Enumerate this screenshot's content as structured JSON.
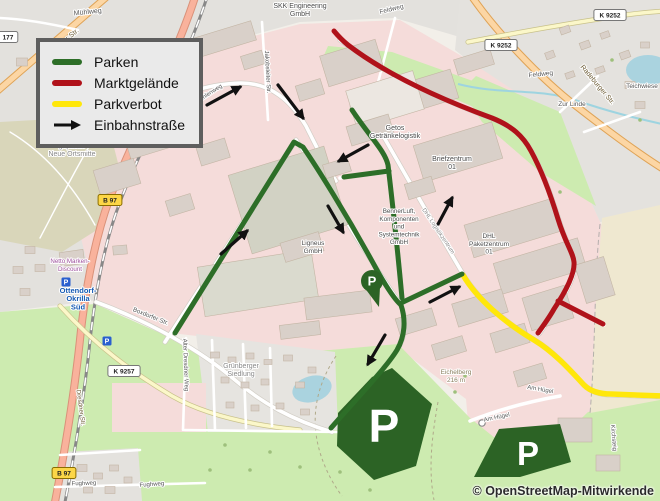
{
  "legend": {
    "items": [
      {
        "label": "Parken",
        "color": "#2d6e28",
        "type": "line"
      },
      {
        "label": "Marktgelände",
        "color": "#b0121a",
        "type": "line"
      },
      {
        "label": "Parkverbot",
        "color": "#ffe70a",
        "type": "line"
      },
      {
        "label": "Einbahnstraße",
        "color": "#111111",
        "type": "arrow"
      }
    ]
  },
  "attribution": "© OpenStreetMap-Mitwirkende",
  "map": {
    "overlays": {
      "parken_color": "#2d6e28",
      "markt_color": "#b0121a",
      "parkverbot_color": "#ffe70a",
      "green_paths": [
        "M175,333 L294,142 L303,147 C316,166 346,213 378,272 C386,286 394,299 401,305",
        "M401,305 C406,320 405,336 397,350 C386,368 358,397 331,428",
        "M401,303 L462,274",
        "M352,110 C370,137 385,151 388,165 C392,199 398,254 402,298",
        "M389,171 L344,177"
      ],
      "red_paths": [
        "M334,31 C339,37 343,41 348,45 C382,71 432,96 492,118 C512,126 523,136 531,151 C543,173 551,196 558,219 C566,245 573,252 574,262 C575,273 566,291 554,309 C549,318 543,326 538,333",
        "M558,301 L603,324"
      ],
      "yellow_paths": [
        "M463,275 C477,299 504,322 534,340 C554,352 571,371 584,385 C590,391 599,394 611,394 L662,396"
      ],
      "arrows": [
        [
          207,
          105,
          240,
          87
        ],
        [
          278,
          85,
          303,
          118
        ],
        [
          368,
          145,
          339,
          161
        ],
        [
          328,
          206,
          343,
          232
        ],
        [
          221,
          254,
          247,
          231
        ],
        [
          436,
          228,
          452,
          198
        ],
        [
          430,
          302,
          459,
          287
        ],
        [
          385,
          335,
          368,
          364
        ]
      ]
    },
    "p_areas": {
      "fill": "#2c6325",
      "label": "P",
      "shapes": [
        {
          "points": "338,413 372,377 392,368 432,404 416,466 374,480 337,446",
          "px": 384,
          "py": 442,
          "fs": 46
        },
        {
          "points": "474,477 499,429 560,424 571,462 520,477",
          "px": 528,
          "py": 465,
          "fs": 33
        }
      ]
    },
    "pin": {
      "x": 372,
      "y": 281,
      "label": "P",
      "fill": "#2c6325"
    },
    "parking_icons": {
      "label": "P",
      "color": "#2a5fcf",
      "positions": [
        [
          66,
          282
        ],
        [
          107,
          341
        ]
      ]
    },
    "gate_marker": [
      482,
      423
    ],
    "badges": [
      {
        "t": "177",
        "x": 8,
        "y": 37
      },
      {
        "t": "K 9252",
        "x": 501,
        "y": 45
      },
      {
        "t": "K 9252",
        "x": 610,
        "y": 15
      },
      {
        "t": "K 9257",
        "x": 124,
        "y": 371
      },
      {
        "t": "B 97",
        "x": 110,
        "y": 200,
        "b": 1
      },
      {
        "t": "B 97",
        "x": 64,
        "y": 473,
        "b": 1
      }
    ],
    "labels": [
      {
        "lines": [
          "SKK Engineering",
          "GmbH"
        ],
        "x": 300,
        "y": 8,
        "s": 7
      },
      {
        "t": "Mühlweg",
        "x": 88,
        "y": 14,
        "s": 7,
        "c": "#555",
        "rot": -6
      },
      {
        "t": "Radeburger Str.",
        "x": 60,
        "y": 47,
        "s": 7,
        "c": "#6b5a33",
        "rot": -39
      },
      {
        "t": "Feldweg",
        "x": 392,
        "y": 11,
        "s": 6.5,
        "c": "#555",
        "rot": -14
      },
      {
        "t": "Feldweg",
        "x": 541,
        "y": 76,
        "s": 6.5,
        "c": "#555",
        "rot": -6
      },
      {
        "t": "Teichwiese",
        "x": 642,
        "y": 88,
        "s": 6.5,
        "c": "#555"
      },
      {
        "t": "Zur Linde",
        "x": 572,
        "y": 106,
        "s": 6.5,
        "c": "#555"
      },
      {
        "t": "Radeburger Str.",
        "x": 596,
        "y": 86,
        "s": 7,
        "c": "#6b5a33",
        "rot": 50
      },
      {
        "lines": [
          "Getos",
          "Getränkelogistik"
        ],
        "x": 395,
        "y": 130,
        "s": 7
      },
      {
        "lines": [
          "Briefzentrum",
          "01"
        ],
        "x": 452,
        "y": 161,
        "s": 7
      },
      {
        "t": "DHL Logistikzentrum",
        "x": 437,
        "y": 232,
        "s": 5.8,
        "c": "#8a8a8a",
        "rot": 56
      },
      {
        "lines": [
          "BennerLuft,",
          "Komponenten",
          "und",
          "Systemtechnik",
          "GmbH"
        ],
        "x": 399,
        "y": 213,
        "s": 6.3
      },
      {
        "lines": [
          "DHL",
          "Paketzentrum",
          "01"
        ],
        "x": 489,
        "y": 238,
        "s": 6.5
      },
      {
        "lines": [
          "Ligneus",
          "GmbH"
        ],
        "x": 313,
        "y": 245,
        "s": 6.5
      },
      {
        "t": "Jakobsleiter Str.",
        "x": 266,
        "y": 72,
        "s": 6,
        "c": "#555",
        "rot": 87
      },
      {
        "t": "Windmühlenweg",
        "x": 204,
        "y": 99,
        "s": 6,
        "c": "#555",
        "rot": -33
      },
      {
        "lines": [
          "geplante",
          "Neue Ortsmitte"
        ],
        "x": 72,
        "y": 148,
        "s": 7,
        "c": "#888"
      },
      {
        "lines": [
          "Netto Marken-",
          "Discount"
        ],
        "x": 70,
        "y": 263,
        "s": 6.2,
        "c": "#9c4f9c"
      },
      {
        "lines": [
          "Ottendorf-",
          "Okrilla",
          "Süd"
        ],
        "x": 78,
        "y": 293,
        "s": 7.5,
        "c": "#1559b3",
        "w": 700,
        "lh": 8.2
      },
      {
        "t": "Boxdorfer Str.",
        "x": 150,
        "y": 318,
        "s": 6.2,
        "c": "#555",
        "rot": 22
      },
      {
        "t": "Alter Dresdner Weg",
        "x": 184,
        "y": 365,
        "s": 6,
        "c": "#555",
        "rot": 88
      },
      {
        "lines": [
          "Grünberger",
          "Siedlung"
        ],
        "x": 241,
        "y": 368,
        "s": 7,
        "c": "#888"
      },
      {
        "t": "Dresdner Str.",
        "x": 79,
        "y": 408,
        "s": 6.2,
        "c": "#6b5a33",
        "rot": 82
      },
      {
        "t": "Fughweg",
        "x": 84,
        "y": 485,
        "s": 6,
        "c": "#555",
        "rot": -2
      },
      {
        "t": "Fughweg",
        "x": 152,
        "y": 486,
        "s": 6,
        "c": "#555",
        "rot": -4
      },
      {
        "lines": [
          "Eichelberg",
          "216 m"
        ],
        "x": 456,
        "y": 374,
        "s": 6.5,
        "c": "#8a7f5f"
      },
      {
        "t": "Am Hügel",
        "x": 540,
        "y": 391,
        "s": 6,
        "c": "#555",
        "rot": 10
      },
      {
        "t": "Am Hügel",
        "x": 497,
        "y": 419,
        "s": 6,
        "c": "#555",
        "rot": -12
      },
      {
        "t": "Kirchsteig",
        "x": 612,
        "y": 438,
        "s": 6,
        "c": "#555",
        "rot": 85
      }
    ],
    "buildings": [
      [
        222,
        40,
        66,
        20,
        -17
      ],
      [
        168,
        72,
        30,
        15,
        -17
      ],
      [
        253,
        60,
        22,
        14,
        -17
      ],
      [
        352,
        63,
        58,
        32,
        -17
      ],
      [
        420,
        94,
        72,
        30,
        -17
      ],
      [
        474,
        62,
        38,
        16,
        -17
      ],
      [
        310,
        90,
        26,
        16,
        -17
      ],
      [
        385,
        100,
        70,
        40,
        -17,
        "#ece7e1"
      ],
      [
        152,
        132,
        56,
        40,
        -17
      ],
      [
        117,
        177,
        42,
        26,
        -17
      ],
      [
        213,
        152,
        30,
        20,
        -17
      ],
      [
        180,
        205,
        26,
        16,
        -17
      ],
      [
        288,
        200,
        100,
        82,
        -17,
        "#d2d2c4"
      ],
      [
        258,
        283,
        115,
        50,
        -9,
        "#dadace"
      ],
      [
        370,
        130,
        44,
        20,
        -17
      ],
      [
        337,
        168,
        26,
        14,
        -17
      ],
      [
        458,
        152,
        82,
        38,
        -17
      ],
      [
        420,
        188,
        28,
        16,
        -17
      ],
      [
        513,
        228,
        92,
        34,
        -17
      ],
      [
        540,
        266,
        88,
        32,
        -17
      ],
      [
        480,
        308,
        52,
        24,
        -17
      ],
      [
        595,
        280,
        30,
        40,
        -17
      ],
      [
        302,
        247,
        40,
        20,
        -17
      ],
      [
        338,
        305,
        66,
        22,
        -7
      ],
      [
        300,
        330,
        40,
        14,
        -7
      ],
      [
        416,
        322,
        38,
        18,
        -17
      ],
      [
        449,
        348,
        32,
        16,
        -17
      ],
      [
        510,
        338,
        36,
        20,
        -17
      ],
      [
        548,
        308,
        44,
        34,
        -17
      ],
      [
        530,
        375,
        30,
        16,
        -17
      ],
      [
        575,
        430,
        34,
        24,
        0
      ],
      [
        608,
        463,
        24,
        16,
        0
      ],
      [
        72,
        258,
        24,
        14,
        -8
      ],
      [
        120,
        250,
        14,
        9,
        -5
      ],
      [
        215,
        355,
        9,
        6,
        0
      ],
      [
        232,
        360,
        8,
        6,
        0
      ],
      [
        250,
        356,
        8,
        6,
        0
      ],
      [
        268,
        362,
        8,
        5,
        0
      ],
      [
        288,
        358,
        9,
        6,
        0
      ],
      [
        225,
        380,
        8,
        6,
        0
      ],
      [
        245,
        385,
        8,
        6,
        0
      ],
      [
        265,
        382,
        8,
        6,
        0
      ],
      [
        300,
        385,
        9,
        6,
        0
      ],
      [
        312,
        370,
        8,
        6,
        0
      ],
      [
        230,
        405,
        8,
        6,
        0
      ],
      [
        255,
        408,
        8,
        6,
        0
      ],
      [
        280,
        406,
        8,
        6,
        0
      ],
      [
        305,
        412,
        9,
        6,
        0
      ],
      [
        565,
        30,
        10,
        7,
        -20
      ],
      [
        585,
        45,
        10,
        7,
        -20
      ],
      [
        605,
        35,
        9,
        6,
        -20
      ],
      [
        625,
        55,
        10,
        7,
        -20
      ],
      [
        600,
        70,
        9,
        6,
        -20
      ],
      [
        630,
        85,
        10,
        7,
        0
      ],
      [
        645,
        45,
        9,
        6,
        0
      ],
      [
        570,
        75,
        9,
        6,
        -20
      ],
      [
        550,
        55,
        9,
        7,
        -20
      ],
      [
        640,
        105,
        10,
        7,
        0
      ],
      [
        82,
        468,
        10,
        7,
        0
      ],
      [
        98,
        476,
        9,
        6,
        0
      ],
      [
        114,
        468,
        9,
        6,
        0
      ],
      [
        88,
        490,
        9,
        6,
        0
      ],
      [
        110,
        490,
        10,
        7,
        0
      ],
      [
        128,
        480,
        8,
        6,
        0
      ],
      [
        22,
        62,
        11,
        8,
        0
      ],
      [
        44,
        78,
        10,
        7,
        0
      ],
      [
        30,
        250,
        10,
        7,
        0
      ],
      [
        18,
        270,
        10,
        7,
        0
      ],
      [
        40,
        268,
        10,
        7,
        0
      ],
      [
        25,
        292,
        10,
        7,
        0
      ]
    ]
  }
}
